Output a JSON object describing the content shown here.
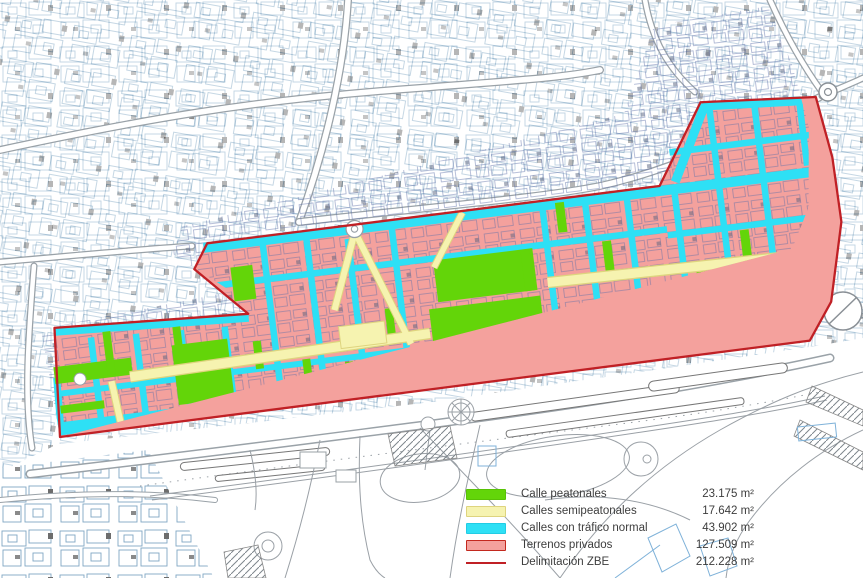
{
  "legend": {
    "items": [
      {
        "label": "Calle peatonales",
        "value": "23.175 m²",
        "color": "#63D509",
        "border": "#58C206",
        "swatch": "rect"
      },
      {
        "label": "Calles semipeatonales",
        "value": "17.642 m²",
        "color": "#F6F3B0",
        "border": "#DED47E",
        "swatch": "rect"
      },
      {
        "label": "Calles con tráfico normal",
        "value": "43.902 m²",
        "color": "#2EE0F5",
        "border": "#22CCE4",
        "swatch": "rect"
      },
      {
        "label": "Terrenos privados",
        "value": "127.509 m²",
        "color": "#F4A19D",
        "border": "#C3281E",
        "swatch": "rect"
      },
      {
        "label": "Delimitación ZBE",
        "value": "212.228 m²",
        "color": "#C02025",
        "border": "#C02025",
        "swatch": "line"
      }
    ]
  }
}
